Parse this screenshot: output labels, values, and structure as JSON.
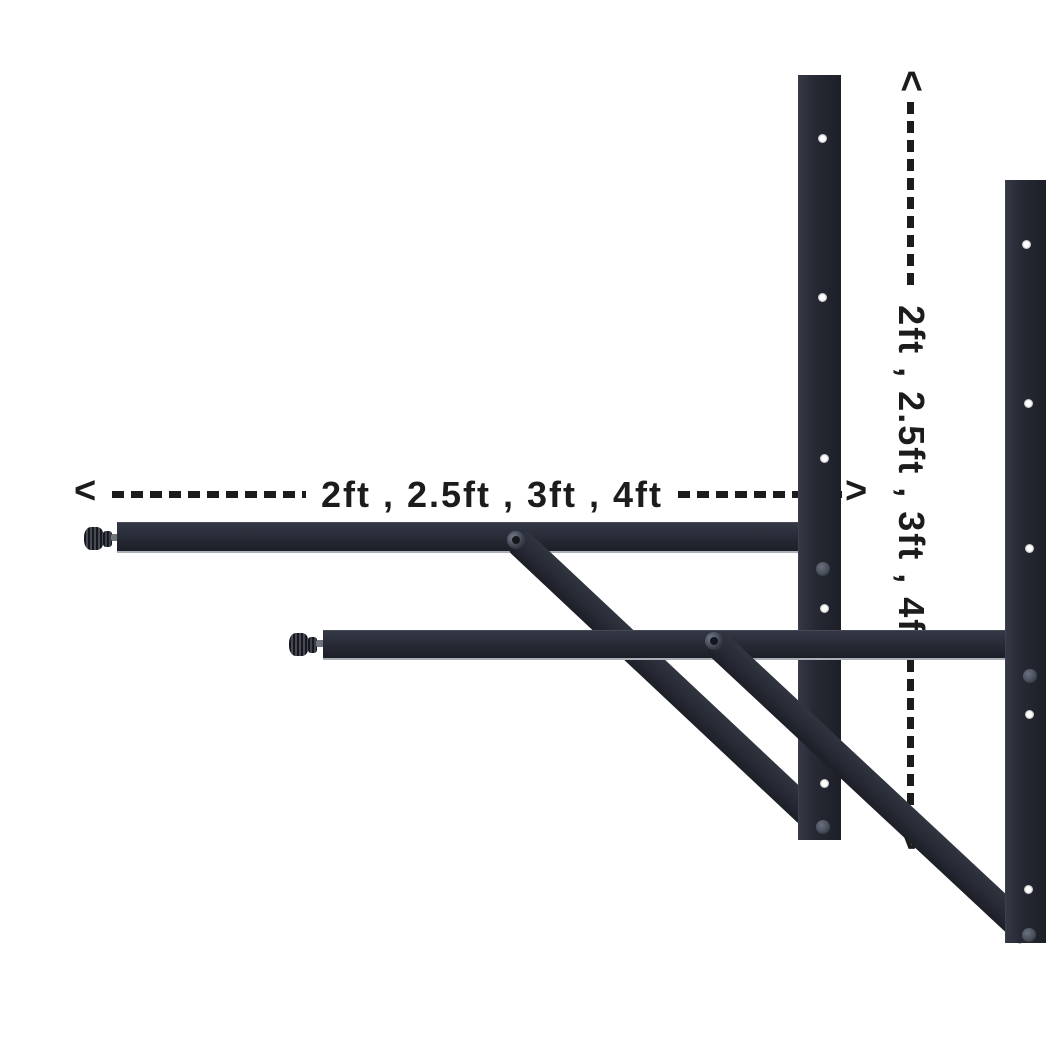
{
  "scene": {
    "description": "Two adjustable black steel wall-mount support brackets (rear and front) shown on a white background with dashed dimension arrows indicating available arm lengths",
    "bracket_count": 2
  },
  "annotations": {
    "horizontal": {
      "left_arrow": "<",
      "label": "2ft , 2.5ft , 3ft , 4ft",
      "right_arrow": ">"
    },
    "vertical": {
      "top_arrow": "<",
      "label": "2ft , 2.5ft , 3ft , 4ft",
      "bottom_arrow": ">"
    }
  },
  "colors": {
    "background": "#ffffff",
    "annotation": "#1c1c1c",
    "bracket_base": "#262a35",
    "bracket_shadow": "#1d1f27",
    "bracket_edge_light": "#aab0b8",
    "hole": "#ffffff",
    "rivet": "#4a4f5b",
    "knob": "#17181d",
    "shaft": "#70747c"
  }
}
